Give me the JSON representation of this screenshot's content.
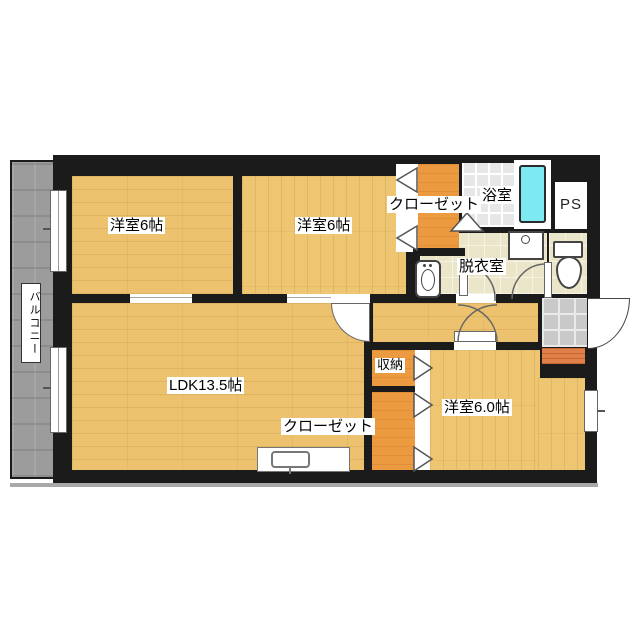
{
  "rooms": {
    "bedroom1": {
      "label": "洋室6帖"
    },
    "bedroom2": {
      "label": "洋室6帖"
    },
    "ldk": {
      "label": "LDK13.5帖"
    },
    "bedroom3": {
      "label": "洋室6.0帖"
    },
    "closet_top": {
      "label": "クローゼット"
    },
    "closet_bottom": {
      "label": "クローゼット"
    },
    "storage": {
      "label": "収納"
    },
    "bathroom": {
      "label": "浴室"
    },
    "washroom": {
      "label": "脱衣室"
    },
    "pipe_space": {
      "label": "PS"
    },
    "balcony": {
      "label": "バルコニー"
    }
  },
  "colors": {
    "wall": "#1b1b1b",
    "wood_floor": "#ecc26e",
    "closet_orange": "#ec9a40",
    "service_cream": "#ebe6c9",
    "bathtub_cyan": "#7de9f1",
    "bath_tile": "#e7e7e7",
    "entry_tile": "#c9c9c9",
    "entry_step": "#e08048",
    "balcony_gray": "#9c9c9c"
  },
  "icons": {
    "bathtub": "bathtub-icon",
    "toilet": "toilet-icon",
    "washbasin": "washbasin-icon",
    "washer_pan": "washing-machine-pan-icon",
    "kitchen_sink": "kitchen-sink-icon"
  }
}
